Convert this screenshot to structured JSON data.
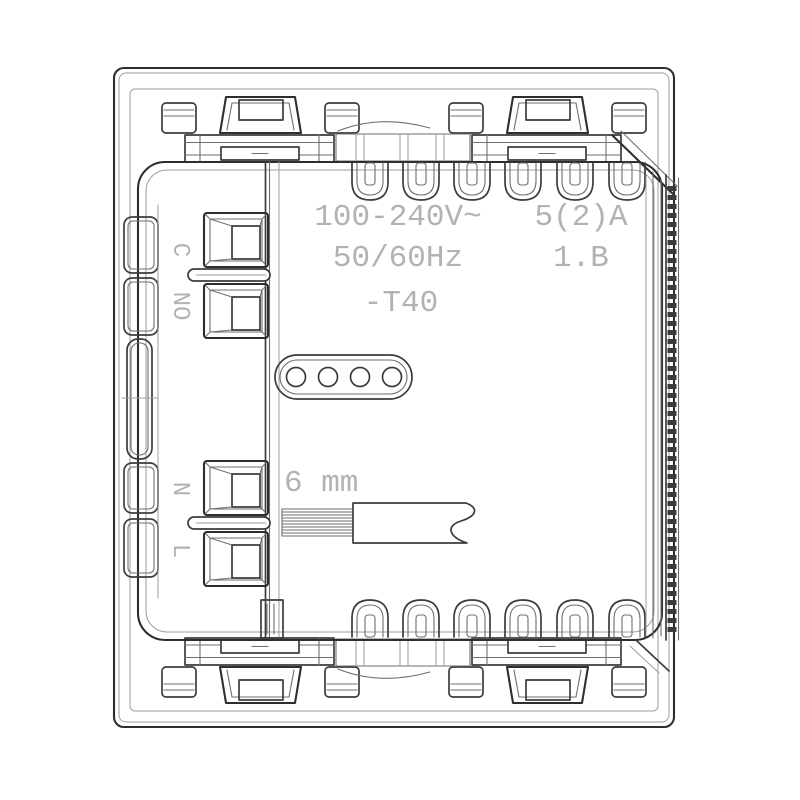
{
  "drawing": {
    "kind": "electrical-module-rear-technical-drawing",
    "labels": {
      "voltage": "100-240V~",
      "frequency": "50/60Hz",
      "current_rating": "5(2)A",
      "insulation_class": "1.B",
      "temperature_rating": "-T40",
      "strip_length": "6 mm",
      "terminal_c": "C",
      "terminal_no": "NO",
      "terminal_n": "N",
      "terminal_l": "L"
    },
    "colors": {
      "background": "#ffffff",
      "line_dark": "#3c3c3c",
      "line_medium": "#6e6e6e",
      "line_light": "#9e9e9e",
      "text": "#b2b2b2"
    }
  }
}
